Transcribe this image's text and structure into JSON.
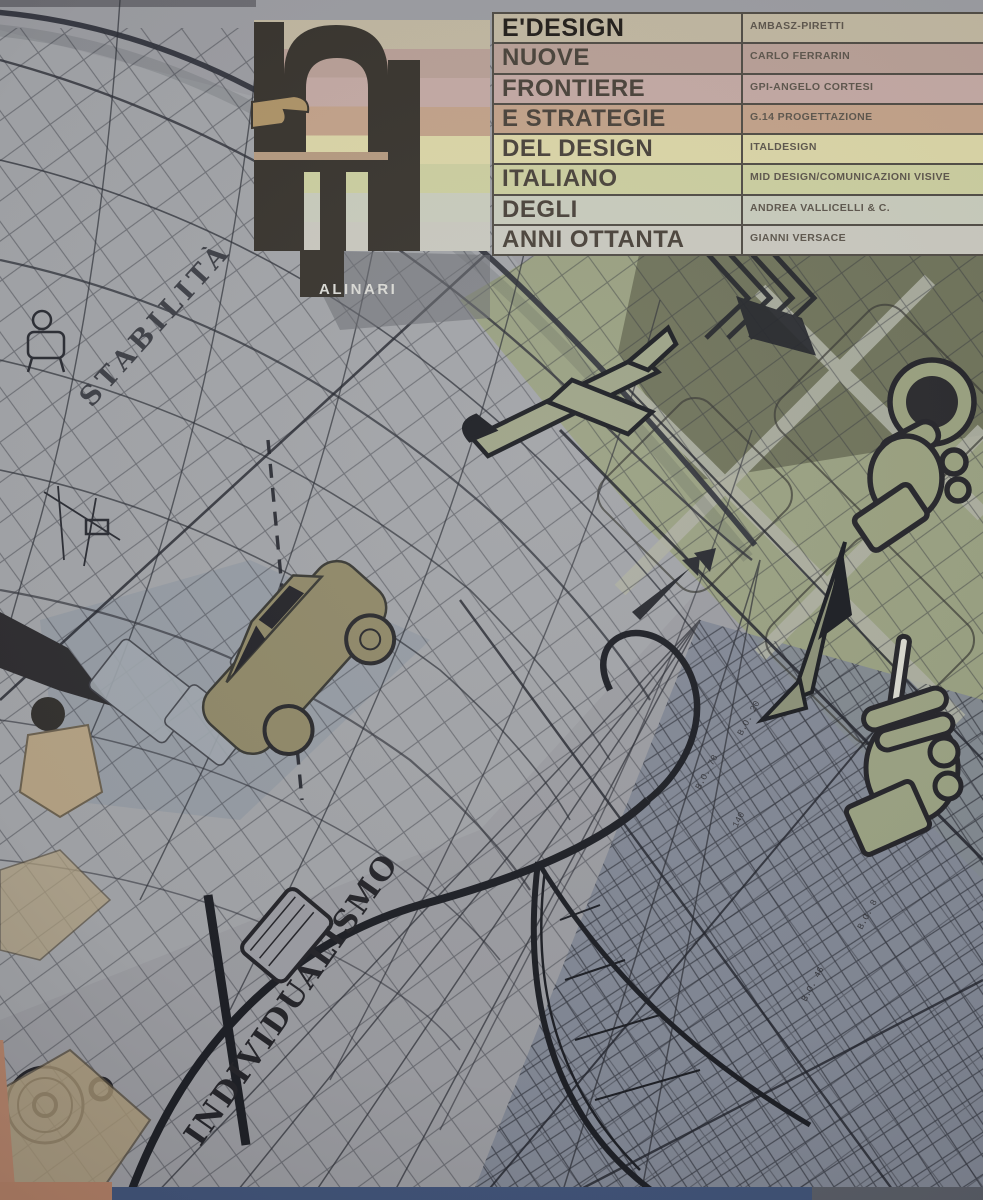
{
  "cover": {
    "publisher": "ALINARI",
    "logo_letters": "ED",
    "title_rows": [
      {
        "title": "E'DESIGN",
        "credit": "AMBASZ-PIRETTI",
        "color": "#bfb6a0"
      },
      {
        "title": "NUOVE",
        "credit": "CARLO FERRARIN",
        "color": "#b79f96"
      },
      {
        "title": "FRONTIERE",
        "credit": "GPI-ANGELO CORTESI",
        "color": "#c2a8a3"
      },
      {
        "title": "E STRATEGIE",
        "credit": "G.14 PROGETTAZIONE",
        "color": "#c1a189"
      },
      {
        "title": "DEL DESIGN",
        "credit": "ITALDESIGN",
        "color": "#d9d4a6"
      },
      {
        "title": "ITALIANO",
        "credit": "MID DESIGN/COMUNICAZIONI VISIVE",
        "color": "#cacd9f"
      },
      {
        "title": "DEGLI",
        "credit": "ANDREA VALLICELLI & C.",
        "color": "#c7cabb"
      },
      {
        "title": "ANNI OTTANTA",
        "credit": "GIANNI VERSACE",
        "color": "#c8c7be"
      }
    ],
    "artwork_words": {
      "stability": "STABILITÀ",
      "individualism": "INDIVIDUALISMO"
    },
    "annotations": [
      "B.O. 20",
      "B.O. 46",
      "B.O. 78",
      "140",
      "B.O. 8"
    ],
    "colors": {
      "cover_gray": "#9b9ca1",
      "ink": "#2c2e35",
      "olive_dark": "#6d7158",
      "olive": "#99a07f",
      "blue_gray": "#7e8593",
      "logo_dark": "#39352f",
      "wood": "#b28066"
    }
  }
}
